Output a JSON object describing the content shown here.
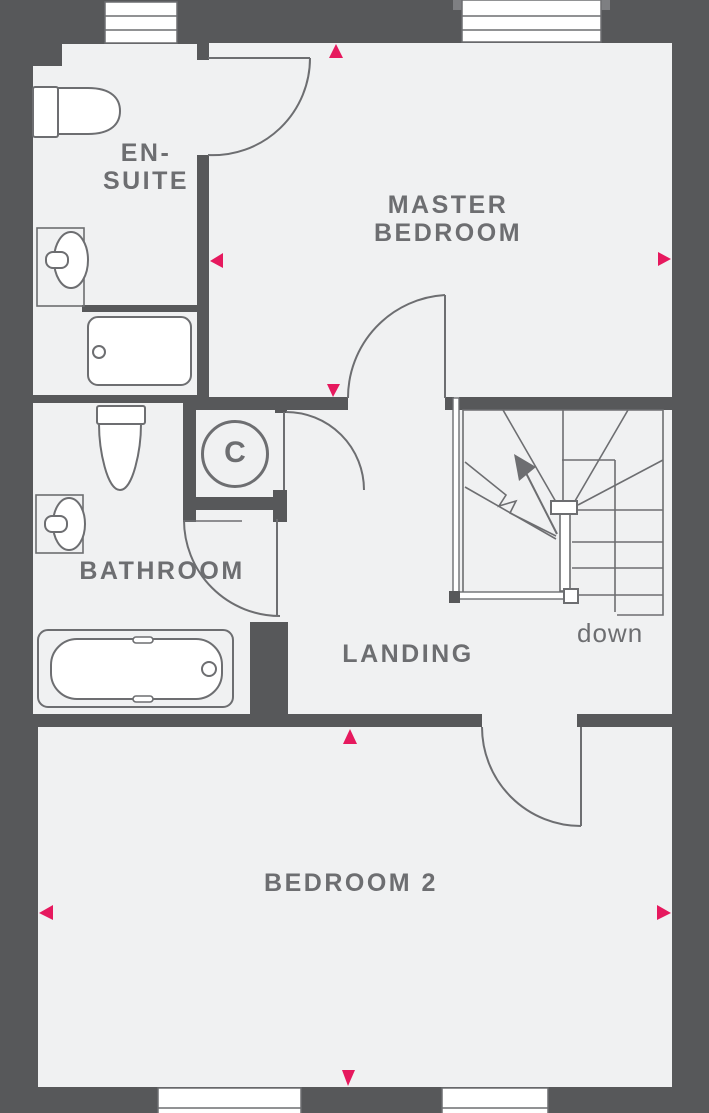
{
  "title": "First floor plan",
  "colors": {
    "wall": "#57585a",
    "floor": "#f0f1f2",
    "line": "#6d6e71",
    "accent": "#e6195e",
    "fixture_fill": "#ffffff"
  },
  "rooms": {
    "en_suite": {
      "name_line1": "EN-",
      "name_line2": "SUITE",
      "fixtures": [
        "toilet-icon",
        "basin-icon",
        "shower-icon"
      ],
      "windows": 1
    },
    "master_bedroom": {
      "name_line1": "MASTER",
      "name_line2": "BEDROOM",
      "windows": 1
    },
    "bathroom": {
      "name": "BATHROOM",
      "fixtures": [
        "toilet-icon",
        "basin-icon",
        "bath-icon"
      ]
    },
    "cupboard": {
      "name": "C"
    },
    "landing": {
      "name": "LANDING"
    },
    "bedroom_2": {
      "name": "BEDROOM 2",
      "windows": 2
    }
  },
  "stairs": {
    "label": "down",
    "type": "winder-staircase",
    "direction_icon": "stair-arrow-icon"
  },
  "markers": {
    "icon": "dimension-arrow-icon",
    "color": "#e6195e",
    "positions": [
      "master-top-up",
      "master-left-left",
      "master-right-right",
      "master-bottom-down",
      "bedroom2-top-up",
      "bedroom2-left-left",
      "bedroom2-right-right",
      "bedroom2-bottom-down"
    ]
  }
}
